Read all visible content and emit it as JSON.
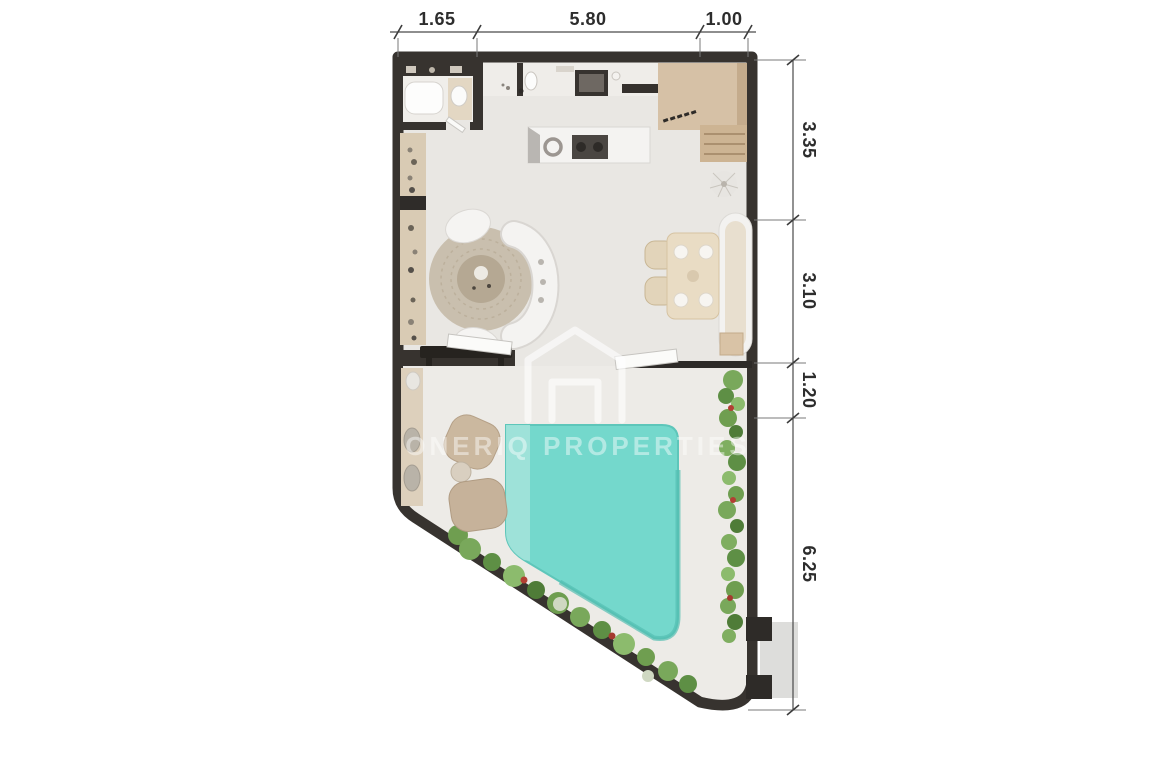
{
  "document": {
    "type": "3d-floor-plan",
    "background": "#ffffff"
  },
  "watermark": {
    "text": "ONERIQ PROPERTIES",
    "logo": "house-outline-icon"
  },
  "dimensions": {
    "top": [
      {
        "label": "1.65"
      },
      {
        "label": "5.80"
      },
      {
        "label": "1.00"
      }
    ],
    "right": [
      {
        "label": "3.35"
      },
      {
        "label": "3.10"
      },
      {
        "label": "1.20"
      },
      {
        "label": "6.25"
      }
    ]
  },
  "colors": {
    "wall": "#37332f",
    "floor_interior": "#e9e7e3",
    "floor_terrace": "#edebe7",
    "pool": "#74d8cc",
    "pool_shallow": "#a3e3da",
    "greenery": "#6f9e50",
    "wood_beige": "#d9cbb4",
    "entry_tan": "#d6c1a6",
    "dimension_text": "#2d2d2d"
  }
}
